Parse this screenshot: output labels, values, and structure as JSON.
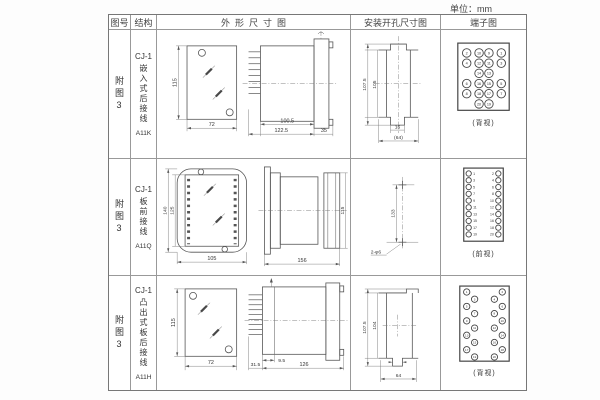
{
  "unit_label": "单位：mm",
  "header": {
    "figure": "图号",
    "structure": "结构",
    "outline": "外形尺寸图",
    "mounting": "安装开孔尺寸图",
    "terminal": "端子图"
  },
  "rows": [
    {
      "figure_label": "附图3",
      "model": "CJ-1",
      "structure_desc": "嵌入式后接线",
      "code": "A11K",
      "outline_dims": {
        "h": "115",
        "w": "72",
        "body": "100.5",
        "overall": "122.5",
        "flange": "35"
      },
      "mounting_dims": {
        "outer": "107.5",
        "inner": "105",
        "slot": "16",
        "overall": "(64)"
      },
      "terminal": {
        "caption": "(背视)",
        "layout": "grid4",
        "grid": [
          [
            "2",
            "10",
            "9",
            "1"
          ],
          [
            "4",
            "12",
            "11",
            "3"
          ],
          [
            null,
            "14",
            "13",
            null
          ],
          [
            "6",
            "16",
            "15",
            "5"
          ],
          [
            "8",
            "18",
            "17",
            "7"
          ],
          [
            null,
            "20",
            "19",
            null
          ]
        ]
      }
    },
    {
      "figure_label": "附图3",
      "model": "CJ-1",
      "structure_desc": "板前接线",
      "code": "A11Q",
      "outline_dims": {
        "outer_h": "140",
        "inner_h": "125",
        "w": "105",
        "depth": "156",
        "rear_h": "115"
      },
      "mounting_dims": {
        "spacing": "133",
        "holes": "2-φ6"
      },
      "terminal": {
        "caption": "(前视)",
        "layout": "twocol",
        "left": [
          "1",
          "3",
          "5",
          "7",
          "9",
          "11",
          "13",
          "15",
          "17",
          "19"
        ],
        "right": [
          "2",
          "4",
          "6",
          "8",
          "10",
          "12",
          "14",
          "16",
          "18",
          "20"
        ]
      }
    },
    {
      "figure_label": "附图3",
      "model": "CJ-1",
      "structure_desc": "凸出式板后接线",
      "code": "A11H",
      "outline_dims": {
        "h": "115",
        "w": "72",
        "pin": "31.5",
        "offset": "9.5",
        "depth": "126"
      },
      "mounting_dims": {
        "outer": "107.5",
        "inner": "104",
        "overall": "64"
      },
      "terminal": {
        "caption": "(背视)",
        "layout": "zigzag",
        "left": [
          "1",
          "3",
          "5",
          "7",
          "9",
          "11",
          "13",
          "15",
          "17",
          "19"
        ],
        "right": [
          "2",
          "4",
          "6",
          "8",
          "10",
          "12",
          "14",
          "16",
          "18",
          "20"
        ]
      }
    }
  ]
}
